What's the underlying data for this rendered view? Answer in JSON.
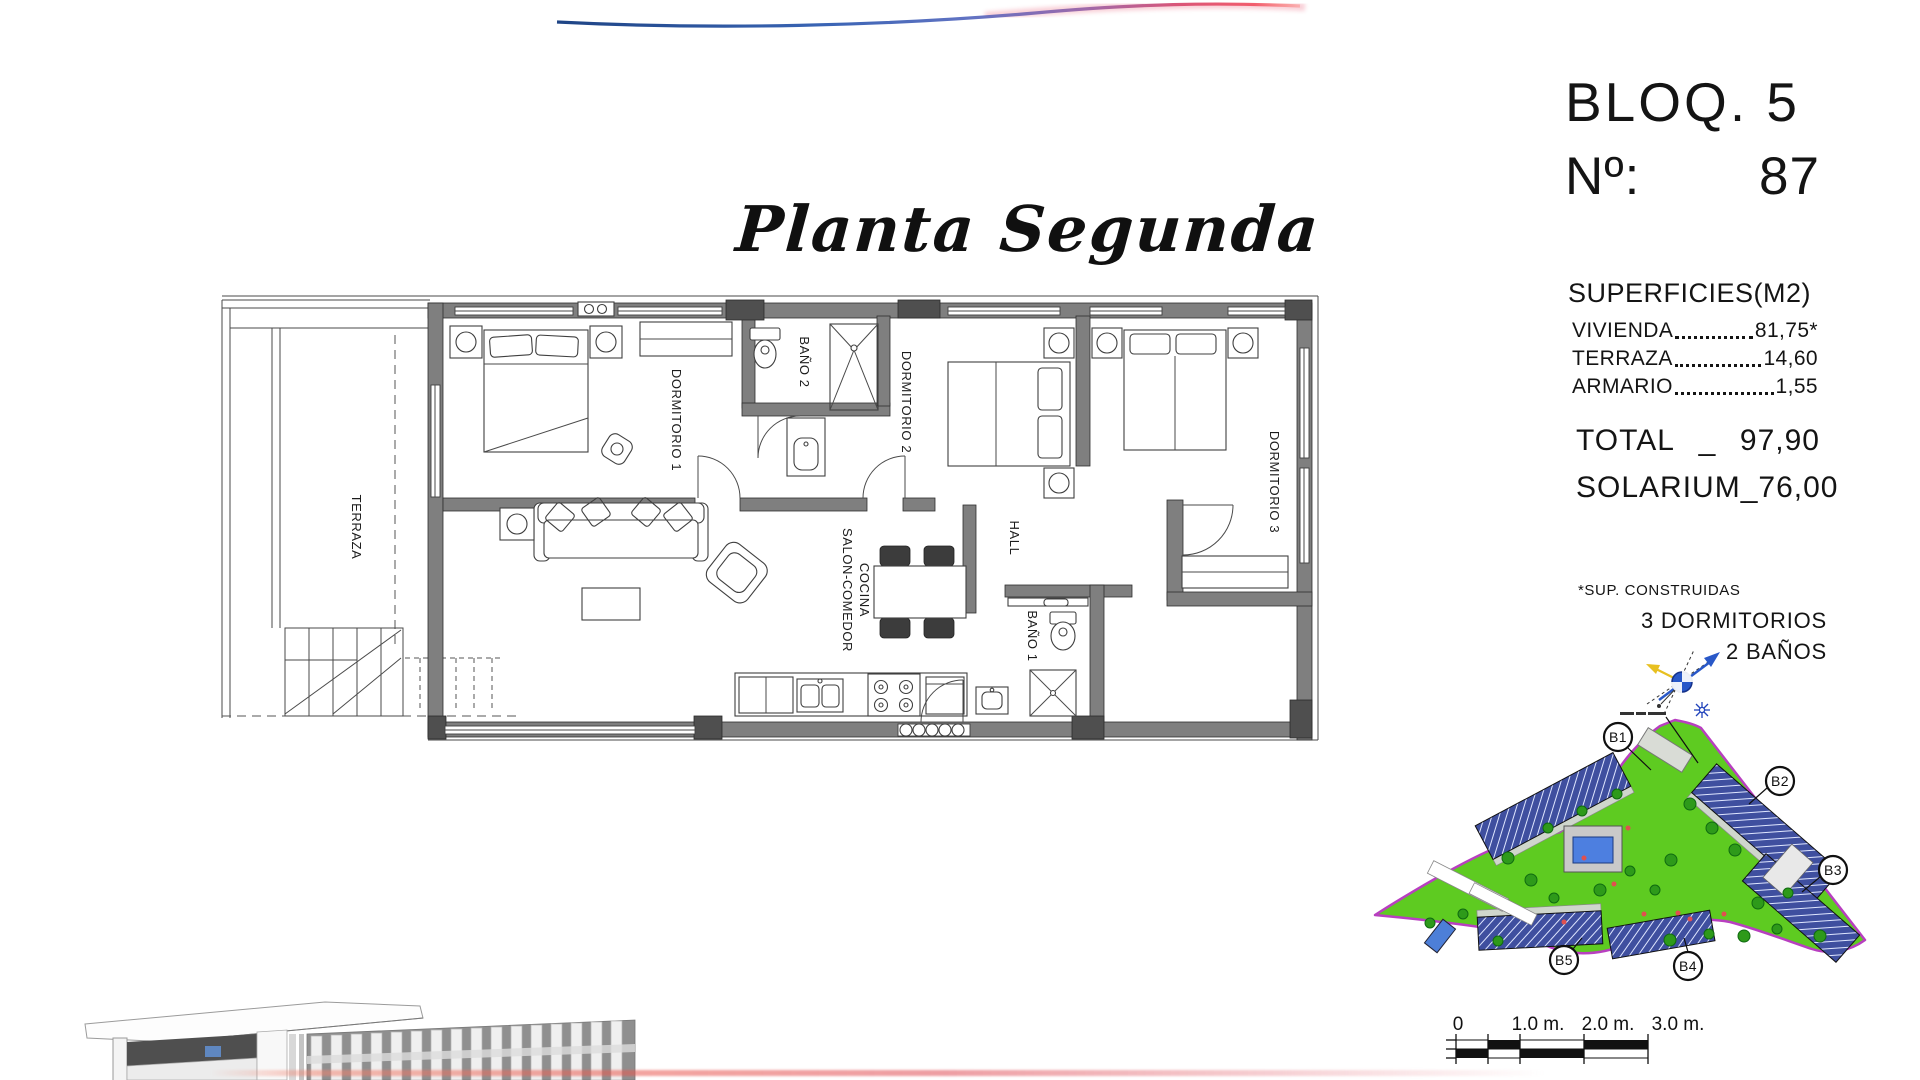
{
  "title": {
    "text": "Planta Segunda"
  },
  "unit_info": {
    "block": "BLOQ. 5",
    "number_label": "Nº:",
    "number": "87"
  },
  "surfaces": {
    "heading": "SUPERFICIES(M2)",
    "rows": [
      {
        "label": "VIVIENDA",
        "value": "81,75*"
      },
      {
        "label": "TERRAZA",
        "value": "14,60"
      },
      {
        "label": "ARMARIO",
        "value": "1,55"
      }
    ],
    "totals": [
      {
        "label": "TOTAL",
        "sep": "_",
        "value": "97,90"
      },
      {
        "label": "SOLARIUM",
        "sep": "_",
        "value": "76,00"
      }
    ],
    "footnote": "*SUP. CONSTRUIDAS",
    "features": [
      "3 DORMITORIOS",
      "2 BAÑOS"
    ]
  },
  "floor_plan": {
    "labels": {
      "terraza": "TERRAZA",
      "dormitorio1": "DORMITORIO 1",
      "bano2": "BAÑO 2",
      "dormitorio2": "DORMITORIO 2",
      "dormitorio3": "DORMITORIO 3",
      "hall": "HALL",
      "salon1": "SALON-COMEDOR",
      "salon2": "COCINA",
      "bano1": "BAÑO 1"
    }
  },
  "site_map": {
    "blocks": [
      {
        "id": "B1"
      },
      {
        "id": "B2"
      },
      {
        "id": "B3"
      },
      {
        "id": "B4"
      },
      {
        "id": "B5"
      }
    ]
  },
  "scale_bar": {
    "labels": [
      "0",
      "1.0 m.",
      "2.0 m.",
      "3.0 m."
    ]
  },
  "colors": {
    "swoosh_blue": "#2f5cb0",
    "swoosh_red": "#e8385a",
    "map_green": "#5ecb21",
    "map_border_magenta": "#b83fc0",
    "building_blue": "#3f4f9f",
    "pool_blue": "#4d7fe0",
    "compass_blue": "#2958c8",
    "compass_yellow": "#e8c020",
    "wall_gray": "#7f7f7f"
  }
}
